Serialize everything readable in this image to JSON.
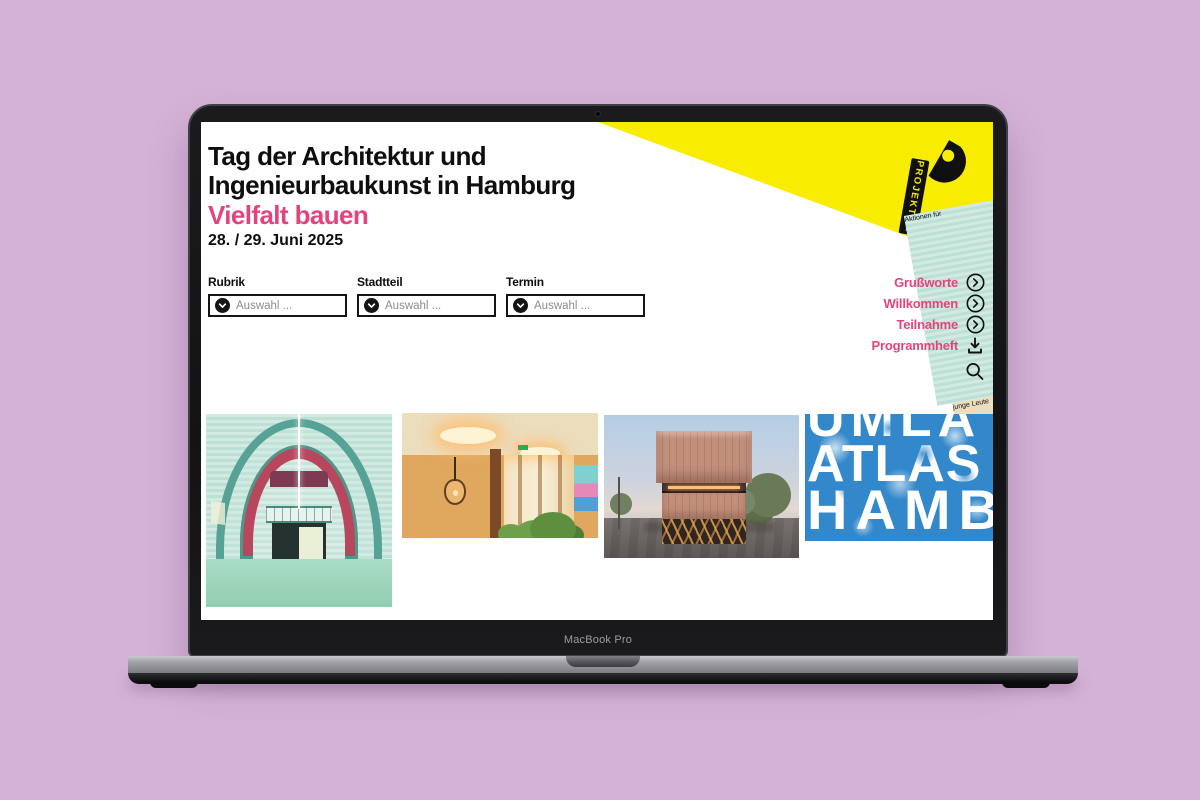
{
  "colors": {
    "page_background": "#d4b2d6",
    "accent_pink": "#e2457d",
    "brand_yellow": "#f8ec00",
    "atlas_blue": "#3388cb"
  },
  "device": {
    "label": "MacBook Pro"
  },
  "site": {
    "header": {
      "title": "Tag der Architektur und\nIngenieurbaukunst in Hamburg",
      "subtitle": "Vielfalt bauen",
      "date": "28. / 29. Juni 2025"
    },
    "logo": {
      "name": "PROJEKTOR",
      "tagline1": "Aktionen für",
      "tagline2": "junge Leute"
    },
    "filters": [
      {
        "label": "Rubrik",
        "value": "Auswahl ..."
      },
      {
        "label": "Stadtteil",
        "value": "Auswahl ..."
      },
      {
        "label": "Termin",
        "value": "Auswahl ..."
      }
    ],
    "nav": [
      {
        "label": "Grußworte"
      },
      {
        "label": "Willkommen"
      },
      {
        "label": "Teilnahme"
      },
      {
        "label": "Programmheft"
      }
    ],
    "gallery": [
      {
        "name": "arched-station-hall-photo"
      },
      {
        "name": "wooden-interior-photo"
      },
      {
        "name": "copper-cube-building-photo"
      },
      {
        "name": "atlas-hamburg-graphic",
        "lines": [
          "UMLA",
          "ATLAS",
          "HAMB"
        ]
      }
    ]
  }
}
